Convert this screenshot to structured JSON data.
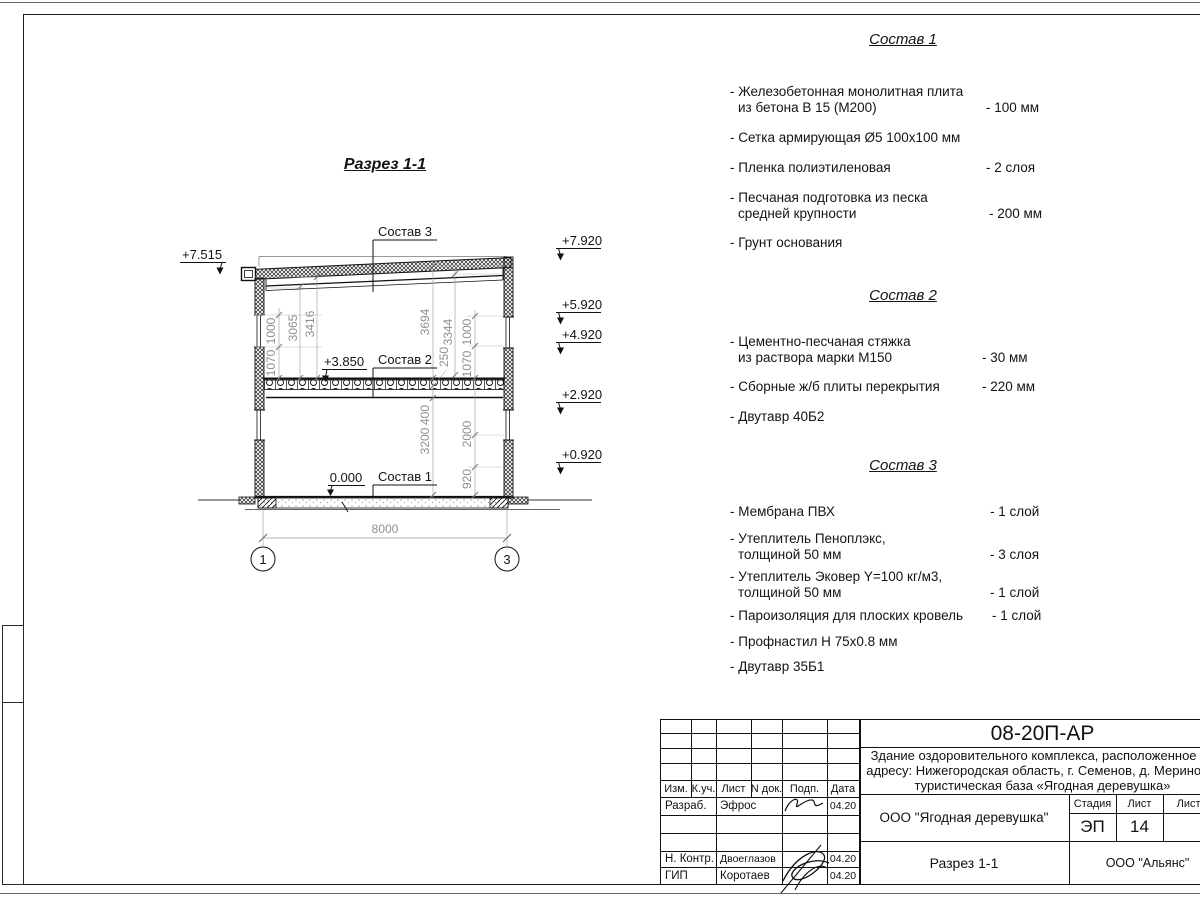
{
  "drawing": {
    "title": "Разрез 1-1",
    "elev_left": "+7.515",
    "elev_r1": "+7.920",
    "elev_r2": "+5.920",
    "elev_r3": "+4.920",
    "elev_r4": "+2.920",
    "elev_r5": "+0.920",
    "lvl_slab": "+3.850",
    "lvl_floor": "0.000",
    "callout_roof": "Состав 3",
    "callout_slab": "Состав 2",
    "callout_floor": "Состав 1",
    "dim_total": "8000",
    "axis_1": "1",
    "axis_3": "3",
    "dl_1000": "1000",
    "dl_1070": "1070",
    "dl_3065": "3065",
    "dl_3416": "3416",
    "dr_3694": "3694",
    "dr_3344": "3344",
    "dr_250": "250",
    "dr_1000": "1000",
    "dr_1070": "1070",
    "dr_400": "400",
    "dr_3200": "3200",
    "dr_2000": "2000",
    "dr_920": "920"
  },
  "sostav1": {
    "title": "Состав 1",
    "i1l1": "- Железобетонная  монолитная плита",
    "i1l2": "из бетона В 15 (М200)",
    "i1v": "- 100 мм",
    "i2": "- Сетка армирующая Ø5 100х100 мм",
    "i3": "- Пленка полиэтиленовая",
    "i3v": "-  2 слоя",
    "i4l1": "- Песчаная подготовка из песка",
    "i4l2": "средней крупности",
    "i4v": "- 200 мм",
    "i5": "- Грунт основания"
  },
  "sostav2": {
    "title": "Состав 2",
    "i1l1": "- Цементно-песчаная стяжка",
    "i1l2": "из раствора марки М150",
    "i1v": "- 30 мм",
    "i2": "- Сборные ж/б плиты перекрытия",
    "i2v": "- 220 мм",
    "i3": "- Двутавр 40Б2"
  },
  "sostav3": {
    "title": "Состав 3",
    "i1": "- Мембрана ПВХ",
    "i1v": "- 1 слой",
    "i2l1": "- Утеплитель Пеноплэкс,",
    "i2l2": "толщиной 50 мм",
    "i2v": "- 3 слоя",
    "i3l1": "- Утеплитель Эковер Y=100 кг/м3,",
    "i3l2": "толщиной 50 мм",
    "i3v": "- 1 слой",
    "i4": "- Пароизоляция для плоских кровель",
    "i4v": "- 1 слой",
    "i5": "- Профнастил Н 75х0.8 мм",
    "i6": "- Двутавр 35Б1"
  },
  "titleblock": {
    "code": "08-20П-АР",
    "desc1": "Здание оздоровительного комплекса, расположенное по",
    "desc2": "адресу: Нижегородская область, г. Семенов, д. Мериново,",
    "desc3": "туристическая база «Ягодная деревушка»",
    "col_izm": "Изм.",
    "col_kuch": "К.уч.",
    "col_list": "Лист",
    "col_ndok": "N док.",
    "col_podp": "Подп.",
    "col_data": "Дата",
    "row1_role": "Разраб.",
    "row1_name": "Эфрос",
    "row1_date": "04.20",
    "row4_role": "Н. Контр.",
    "row4_name": "Двоеглазов",
    "row4_date": "04.20",
    "row5_role": "ГИП",
    "row5_name": "Коротаев",
    "row5_date": "04.20",
    "org": "ООО \"Ягодная деревушка\"",
    "stage_h": "Стадия",
    "sheet_h": "Лист",
    "sheets_h": "Листов",
    "stage": "ЭП",
    "sheet": "14",
    "view": "Разрез 1-1",
    "contractor": "ООО \"Альянс\""
  }
}
